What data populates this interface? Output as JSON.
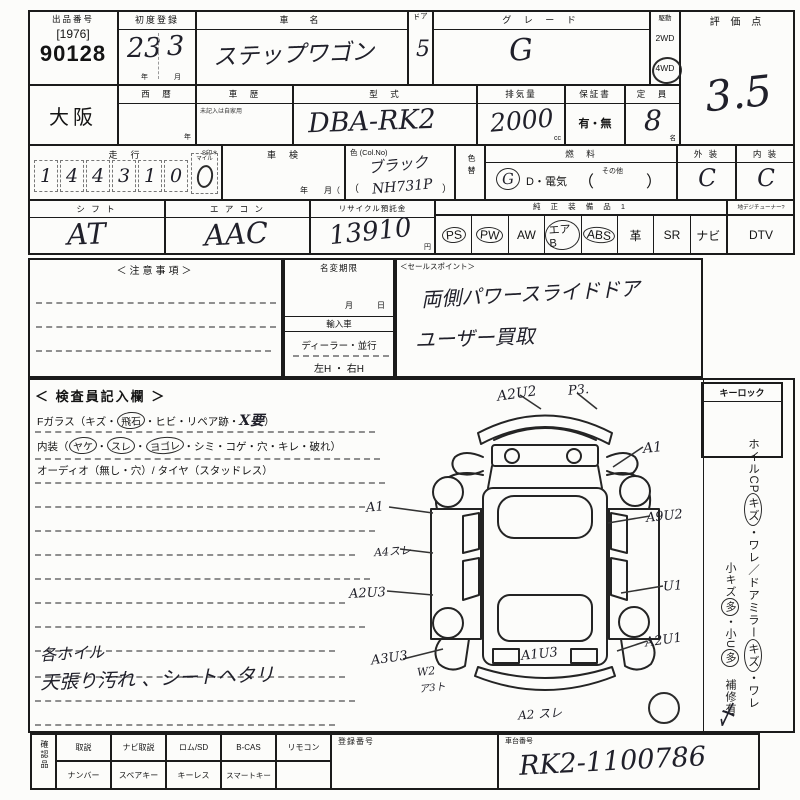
{
  "sheet": {
    "lot": {
      "label": "出品番号",
      "bracket": "[1976]",
      "number": "90128"
    },
    "first_reg": {
      "label": "初度登録",
      "year": "23",
      "month": "3",
      "year_unit": "年",
      "month_unit": "月"
    },
    "car_name": {
      "label": "車　名",
      "value": "ステップワゴン"
    },
    "door": {
      "label": "ドア",
      "value": "5"
    },
    "grade": {
      "label": "グ レ ー ド",
      "value": "G"
    },
    "drive": {
      "label": "駆動",
      "opt_2wd": "2WD",
      "opt_4wd": "4WD"
    },
    "score": {
      "label": "評 価 点",
      "value": "3.5"
    },
    "region": {
      "value": "大阪"
    },
    "seireki": {
      "label": "西　暦",
      "unit": "年"
    },
    "history": {
      "label": "車　歴",
      "note": "未記入は自家用"
    },
    "model": {
      "label": "型　式",
      "value": "DBA-RK2"
    },
    "displacement": {
      "label": "排気量",
      "value": "2000",
      "unit": "cc"
    },
    "warranty": {
      "label": "保証書",
      "value": "有・無"
    },
    "capacity": {
      "label": "定　員",
      "value": "8",
      "unit": "名"
    },
    "mileage": {
      "label": "走　行",
      "s_mark": "S印＊",
      "digits": [
        "1",
        "4",
        "4",
        "3",
        "1",
        "0"
      ],
      "mile_label": "マイル"
    },
    "shaken": {
      "label": "車　検",
      "ym": "年　　月（"
    },
    "color": {
      "label": "色 (Col.No)",
      "value": "ブラック",
      "open": "（",
      "no": "NH731P",
      "close": "）"
    },
    "color_change": {
      "label": "色替"
    },
    "fuel": {
      "label": "燃　料",
      "g": "G",
      "rest": "D・電気",
      "open": "（",
      "other": "その他",
      "close": "）"
    },
    "exterior": {
      "label": "外 装",
      "value": "C"
    },
    "interior": {
      "label": "内 装",
      "value": "C"
    },
    "shift": {
      "label": "シ フ ト",
      "value": "AT"
    },
    "aircon": {
      "label": "エ ア コ ン",
      "value": "AAC"
    },
    "recycle": {
      "label": "リサイクル預託金",
      "value": "13910",
      "unit": "円"
    },
    "equipment": {
      "label": "純 正 装 備 品 1",
      "dtv_label": "地デジチューナー?",
      "items": [
        "PS",
        "PW",
        "AW",
        "エアB",
        "ABS",
        "革",
        "SR",
        "ナビ",
        "DTV"
      ]
    },
    "caution": {
      "label": "＜注意事項＞"
    },
    "name_change": {
      "label": "名変期限",
      "md": "月　　　日",
      "import_label": "輸入車",
      "import_type": "ディーラー・並行",
      "handle": "左H ・ 右H"
    },
    "sales": {
      "label": "＜セールスポイント＞",
      "line1": "両側パワースライドドア",
      "line2": "ユーザー買取"
    },
    "inspector": {
      "title": "＜ 検査員記入欄 ＞",
      "l1a": "Fガラス（キズ・",
      "l1b": "飛石",
      "l1c": "・ヒビ・リペア跡・",
      "l1d": "X要",
      "l1e": "）",
      "l2a": "内装（",
      "l2b": "ヤケ",
      "l2c": "・",
      "l2d": "スレ",
      "l2e": "・",
      "l2f": "ヨゴレ",
      "l2g": "・シミ・コゲ・穴・キレ・破れ）",
      "l3": "オーディオ（無し・穴）/ タイヤ（スタッドレス）",
      "note1": "各ホイル",
      "note2": "天張り汚れ 、シートヘタリ"
    },
    "diagram": {
      "annotations": [
        {
          "label": "A2U2"
        },
        {
          "label": "P3."
        },
        {
          "label": "A1"
        },
        {
          "label": "A1"
        },
        {
          "label": "A4スレ"
        },
        {
          "label": "A2U3"
        },
        {
          "label": "A3U3"
        },
        {
          "label": "W2"
        },
        {
          "label": "ア3ト"
        },
        {
          "label": "A1U3"
        },
        {
          "label": "A2 スレ"
        },
        {
          "label": "A9U2"
        },
        {
          "label": "U1"
        },
        {
          "label": "A2U1"
        }
      ]
    },
    "right_col": {
      "keylock": "キーロック",
      "s1a": "ホイルCP",
      "s1b": "キズ",
      "s1c": "・ワレ／ドアミラー",
      "s1d": "キズ",
      "s1e": "・ワレ",
      "s2a": "小キズ",
      "s2b": "多",
      "s2c": "・小U",
      "s2d": "多",
      "s2e": "　補修有",
      "scribble": "〆"
    },
    "footer": {
      "side": "確認品",
      "r1": [
        "取説",
        "ナビ取説",
        "ロム/SD",
        "B-CAS",
        "リモコン"
      ],
      "r2": [
        "ナンバー",
        "スペアキー",
        "キーレス",
        "スマートキー"
      ],
      "reg_label": "登録番号",
      "chassis_label": "車台番号",
      "chassis_value": "RK2-1100786"
    }
  }
}
